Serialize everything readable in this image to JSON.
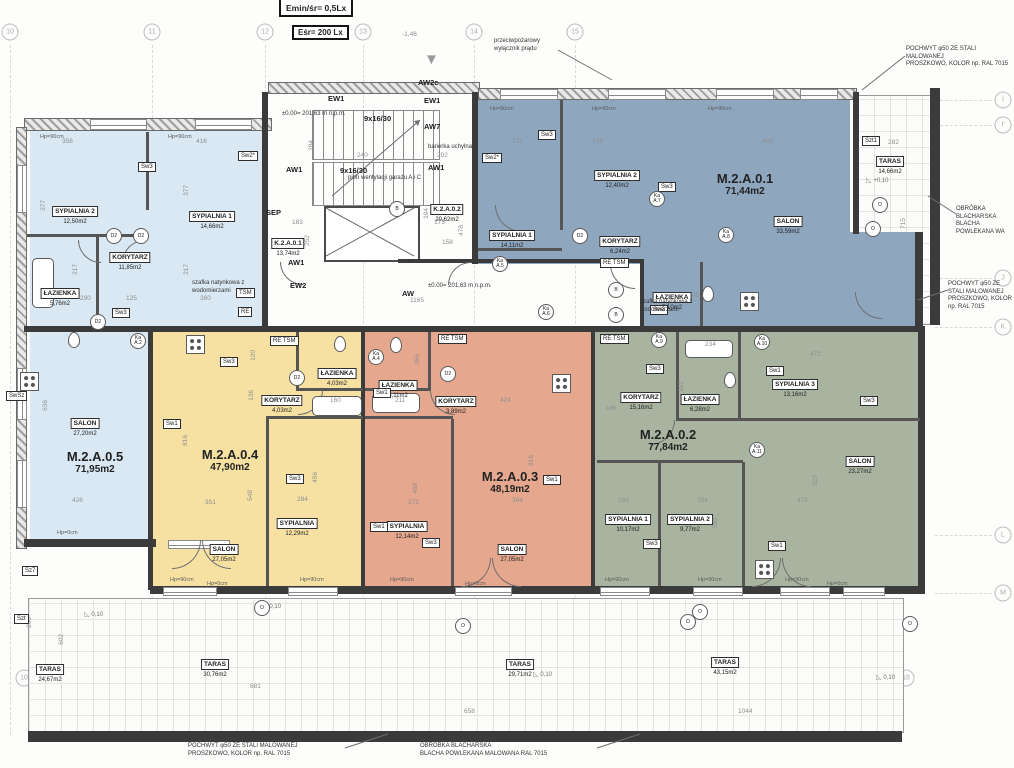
{
  "legend": {
    "l1": "Emin/śr= 0,5Lx",
    "l2": "Eśr=  200 Lx"
  },
  "icons": {
    "fire_triangle": "▼"
  },
  "grid": {
    "top": [
      {
        "l": "10",
        "x": 10
      },
      {
        "l": "11",
        "x": 152
      },
      {
        "l": "12",
        "x": 265
      },
      {
        "l": "13",
        "x": 363
      },
      {
        "l": "14",
        "x": 474
      },
      {
        "l": "15",
        "x": 575
      }
    ],
    "bottom": [
      {
        "l": "10",
        "x": 24
      },
      {
        "l": "11",
        "x": 153
      },
      {
        "l": "12",
        "x": 266
      },
      {
        "l": "14",
        "x": 474
      },
      {
        "l": "15",
        "x": 573
      },
      {
        "l": "16",
        "x": 748
      },
      {
        "l": "17",
        "x": 843
      },
      {
        "l": "18",
        "x": 906
      }
    ],
    "right": [
      {
        "l": "I",
        "y": 100
      },
      {
        "l": "I'",
        "y": 125
      },
      {
        "l": "J",
        "y": 278
      },
      {
        "l": "K",
        "y": 327
      },
      {
        "l": "L",
        "y": 535
      },
      {
        "l": "M",
        "y": 593
      }
    ]
  },
  "apartments": [
    {
      "id": "M.2.A.0.5",
      "area": "71,95m2",
      "color": "#d9e8f3",
      "lx": 95,
      "ly": 450,
      "rooms": [
        {
          "name": "SYPIALNIA 2",
          "area": "12,50m2",
          "x": 75,
          "y": 200
        },
        {
          "name": "SYPIALNIA 1",
          "area": "14,66m2",
          "x": 212,
          "y": 205
        },
        {
          "name": "KORYTARZ",
          "area": "11,85m2",
          "x": 130,
          "y": 246
        },
        {
          "name": "ŁAZIENKA",
          "area": "5,76m2",
          "x": 60,
          "y": 282
        },
        {
          "name": "SALON",
          "area": "27,20m2",
          "x": 85,
          "y": 412
        }
      ]
    },
    {
      "id": "M.2.A.0.1",
      "area": "71,44m2",
      "color": "#8ea7bf",
      "lx": 745,
      "ly": 172,
      "rooms": [
        {
          "name": "SYPIALNIA 2",
          "area": "12,40m2",
          "x": 617,
          "y": 164
        },
        {
          "name": "SYPIALNIA 1",
          "area": "14,11m2",
          "x": 512,
          "y": 224
        },
        {
          "name": "KORYTARZ",
          "area": "6,24m2",
          "x": 620,
          "y": 230
        },
        {
          "name": "SALON",
          "area": "33,59m2",
          "x": 788,
          "y": 210
        },
        {
          "name": "ŁAZIENKA",
          "area": "5,10m2",
          "x": 672,
          "y": 286
        }
      ]
    },
    {
      "id": "M.2.A.0.4",
      "area": "47,90m2",
      "color": "#f6e1a3",
      "lx": 230,
      "ly": 448,
      "rooms": [
        {
          "name": "ŁAZIENKA",
          "area": "4,03m2",
          "x": 337,
          "y": 362
        },
        {
          "name": "KORYTARZ",
          "area": "4,03m2",
          "x": 282,
          "y": 389
        },
        {
          "name": "SYPIALNIA",
          "area": "12,29m2",
          "x": 297,
          "y": 512
        },
        {
          "name": "SALON",
          "area": "27,05m2",
          "x": 224,
          "y": 538
        }
      ]
    },
    {
      "id": "M.2.A.0.3",
      "area": "48,19m2",
      "color": "#e5a78e",
      "lx": 510,
      "ly": 470,
      "rooms": [
        {
          "name": "ŁAZIENKA",
          "area": "5,11m2",
          "x": 398,
          "y": 374
        },
        {
          "name": "KORYTARZ",
          "area": "3,89m2",
          "x": 456,
          "y": 390
        },
        {
          "name": "SYPIALNIA",
          "area": "12,14m2",
          "x": 407,
          "y": 515
        },
        {
          "name": "SALON",
          "area": "27,05m2",
          "x": 512,
          "y": 538
        }
      ]
    },
    {
      "id": "M.2.A.0.2",
      "area": "77,84m2",
      "color": "#a8b4a0",
      "lx": 668,
      "ly": 428,
      "rooms": [
        {
          "name": "KORYTARZ",
          "area": "15,16m2",
          "x": 641,
          "y": 386
        },
        {
          "name": "ŁAZIENKA",
          "area": "6,28m2",
          "x": 700,
          "y": 388
        },
        {
          "name": "SYPIALNIA 3",
          "area": "13,16m2",
          "x": 795,
          "y": 373
        },
        {
          "name": "SALON",
          "area": "23,27m2",
          "x": 860,
          "y": 450
        },
        {
          "name": "SYPIALNIA 1",
          "area": "10,17m2",
          "x": 628,
          "y": 508
        },
        {
          "name": "SYPIALNIA 2",
          "area": "9,77m2",
          "x": 690,
          "y": 508
        }
      ]
    }
  ],
  "core_rooms": [
    {
      "name": "K.2.A.0.1",
      "area": "13,74m2",
      "x": 288,
      "y": 232
    },
    {
      "name": "K.2.A.0.2",
      "area": "20,62m2",
      "x": 447,
      "y": 198
    }
  ],
  "terraces": [
    {
      "name": "TARAS",
      "area": "24,67m2",
      "x": 50,
      "y": 658
    },
    {
      "name": "TARAS",
      "area": "30,76m2",
      "x": 215,
      "y": 653
    },
    {
      "name": "TARAS",
      "area": "29,71m2",
      "x": 520,
      "y": 653
    },
    {
      "name": "TARAS",
      "area": "43,15m2",
      "x": 725,
      "y": 651
    },
    {
      "name": "TARAS",
      "area": "14,66m2",
      "x": 890,
      "y": 150
    }
  ],
  "labels": [
    {
      "t": "EW1",
      "x": 328,
      "y": 94
    },
    {
      "t": "EW1",
      "x": 424,
      "y": 96
    },
    {
      "t": "AW7",
      "x": 424,
      "y": 122
    },
    {
      "t": "AW2c",
      "x": 418,
      "y": 78
    },
    {
      "t": "AW1",
      "x": 286,
      "y": 165
    },
    {
      "t": "AW1",
      "x": 428,
      "y": 163
    },
    {
      "t": "AW1",
      "x": 288,
      "y": 258
    },
    {
      "t": "EW2",
      "x": 290,
      "y": 281
    },
    {
      "t": "SEP",
      "x": 266,
      "y": 208
    },
    {
      "t": "AW",
      "x": 402,
      "y": 289
    },
    {
      "t": "9x16/30",
      "x": 364,
      "y": 114
    },
    {
      "t": "9x16/30",
      "x": 340,
      "y": 166
    }
  ],
  "tags": [
    {
      "t": "Sw3",
      "x": 138,
      "y": 162
    },
    {
      "t": "Sw2*",
      "x": 238,
      "y": 151
    },
    {
      "t": "Sw3",
      "x": 112,
      "y": 308
    },
    {
      "t": "SwSz",
      "x": 6,
      "y": 391
    },
    {
      "t": "Sz7",
      "x": 22,
      "y": 566
    },
    {
      "t": "Szt",
      "x": 14,
      "y": 614
    },
    {
      "t": "Szt1",
      "x": 862,
      "y": 136
    },
    {
      "t": "Sw1",
      "x": 163,
      "y": 419
    },
    {
      "t": "Sw3",
      "x": 220,
      "y": 357
    },
    {
      "t": "Sw3",
      "x": 286,
      "y": 474
    },
    {
      "t": "Sw1",
      "x": 373,
      "y": 388
    },
    {
      "t": "Sw1",
      "x": 370,
      "y": 522
    },
    {
      "t": "Sw3",
      "x": 422,
      "y": 538
    },
    {
      "t": "Sw1",
      "x": 543,
      "y": 475
    },
    {
      "t": "Sw3",
      "x": 646,
      "y": 364
    },
    {
      "t": "Sw1",
      "x": 766,
      "y": 366
    },
    {
      "t": "Sw3",
      "x": 860,
      "y": 396
    },
    {
      "t": "Sw3",
      "x": 643,
      "y": 539
    },
    {
      "t": "Sw1",
      "x": 768,
      "y": 541
    },
    {
      "t": "Sw3",
      "x": 538,
      "y": 130
    },
    {
      "t": "Sw2*",
      "x": 482,
      "y": 153
    },
    {
      "t": "Sw3",
      "x": 658,
      "y": 182
    },
    {
      "t": "Sw2",
      "x": 650,
      "y": 305
    },
    {
      "t": "TSM",
      "x": 236,
      "y": 288
    },
    {
      "t": "RE",
      "x": 238,
      "y": 307
    },
    {
      "t": "RE TSM",
      "x": 270,
      "y": 336
    },
    {
      "t": "RE TSM",
      "x": 438,
      "y": 334
    },
    {
      "t": "RE TSM",
      "x": 600,
      "y": 334
    },
    {
      "t": "RE TSM",
      "x": 600,
      "y": 258
    }
  ],
  "circles": [
    {
      "t": "D2",
      "x": 114,
      "y": 236
    },
    {
      "t": "D2",
      "x": 141,
      "y": 236
    },
    {
      "t": "D2",
      "x": 98,
      "y": 322
    },
    {
      "t": "D2",
      "x": 580,
      "y": 236
    },
    {
      "t": "D2",
      "x": 448,
      "y": 374
    },
    {
      "t": "D2",
      "x": 297,
      "y": 378
    },
    {
      "t": "B",
      "x": 397,
      "y": 209
    },
    {
      "t": "B",
      "x": 616,
      "y": 290
    },
    {
      "t": "B",
      "x": 616,
      "y": 315
    },
    {
      "t": "Ka\nA.2",
      "x": 138,
      "y": 341
    },
    {
      "t": "Ka\nA.4",
      "x": 376,
      "y": 357
    },
    {
      "t": "Ka\nA.9",
      "x": 659,
      "y": 340
    },
    {
      "t": "Ka\nA.10",
      "x": 762,
      "y": 342
    },
    {
      "t": "Ka\nA.11",
      "x": 757,
      "y": 450
    },
    {
      "t": "Ka\nA.7",
      "x": 657,
      "y": 199
    },
    {
      "t": "Ka\nA.8",
      "x": 726,
      "y": 235
    },
    {
      "t": "Ka\nA.5",
      "x": 500,
      "y": 264
    },
    {
      "t": "Ka\nA.6",
      "x": 546,
      "y": 312
    },
    {
      "t": "O",
      "x": 262,
      "y": 608
    },
    {
      "t": "O",
      "x": 463,
      "y": 626
    },
    {
      "t": "O",
      "x": 688,
      "y": 622
    },
    {
      "t": "O",
      "x": 910,
      "y": 624
    },
    {
      "t": "O",
      "x": 880,
      "y": 205
    },
    {
      "t": "O",
      "x": 873,
      "y": 229
    },
    {
      "t": "O",
      "x": 700,
      "y": 612
    }
  ],
  "dims": [
    {
      "t": "358",
      "x": 62,
      "y": 138
    },
    {
      "t": "416",
      "x": 196,
      "y": 138
    },
    {
      "t": "377",
      "x": 40,
      "y": 200,
      "v": 1
    },
    {
      "t": "377",
      "x": 183,
      "y": 185,
      "v": 1
    },
    {
      "t": "290",
      "x": 80,
      "y": 295
    },
    {
      "t": "125",
      "x": 126,
      "y": 295
    },
    {
      "t": "360",
      "x": 200,
      "y": 295
    },
    {
      "t": "217",
      "x": 72,
      "y": 264,
      "v": 1
    },
    {
      "t": "217",
      "x": 183,
      "y": 264,
      "v": 1
    },
    {
      "t": "636",
      "x": 42,
      "y": 400,
      "v": 1
    },
    {
      "t": "426",
      "x": 72,
      "y": 497
    },
    {
      "t": "816",
      "x": 182,
      "y": 435,
      "v": 1
    },
    {
      "t": "351",
      "x": 205,
      "y": 499
    },
    {
      "t": "548",
      "x": 247,
      "y": 490,
      "v": 1
    },
    {
      "t": "456",
      "x": 312,
      "y": 472,
      "v": 1
    },
    {
      "t": "284",
      "x": 297,
      "y": 496
    },
    {
      "t": "120",
      "x": 250,
      "y": 350,
      "v": 1
    },
    {
      "t": "136",
      "x": 248,
      "y": 390,
      "v": 1
    },
    {
      "t": "160",
      "x": 330,
      "y": 397
    },
    {
      "t": "424",
      "x": 500,
      "y": 397
    },
    {
      "t": "364",
      "x": 512,
      "y": 497
    },
    {
      "t": "468",
      "x": 412,
      "y": 483,
      "v": 1
    },
    {
      "t": "271",
      "x": 408,
      "y": 499
    },
    {
      "t": "211",
      "x": 395,
      "y": 397
    },
    {
      "t": "256",
      "x": 414,
      "y": 354,
      "v": 1
    },
    {
      "t": "816",
      "x": 528,
      "y": 455,
      "v": 1
    },
    {
      "t": "234",
      "x": 705,
      "y": 341
    },
    {
      "t": "472",
      "x": 810,
      "y": 351
    },
    {
      "t": "282",
      "x": 678,
      "y": 381,
      "v": 1
    },
    {
      "t": "146",
      "x": 605,
      "y": 405
    },
    {
      "t": "264",
      "x": 618,
      "y": 497
    },
    {
      "t": "254",
      "x": 697,
      "y": 497
    },
    {
      "t": "472",
      "x": 797,
      "y": 497
    },
    {
      "t": "522",
      "x": 812,
      "y": 475,
      "v": 1
    },
    {
      "t": "390",
      "x": 712,
      "y": 518,
      "v": 1
    },
    {
      "t": "271",
      "x": 512,
      "y": 138
    },
    {
      "t": "379",
      "x": 592,
      "y": 138
    },
    {
      "t": "483",
      "x": 762,
      "y": 138
    },
    {
      "t": "275",
      "x": 688,
      "y": 292
    },
    {
      "t": "284",
      "x": 308,
      "y": 140,
      "v": 1
    },
    {
      "t": "240",
      "x": 357,
      "y": 152
    },
    {
      "t": "202",
      "x": 437,
      "y": 152
    },
    {
      "t": "478",
      "x": 458,
      "y": 225,
      "v": 1
    },
    {
      "t": "194",
      "x": 423,
      "y": 208,
      "v": 1
    },
    {
      "t": "173",
      "x": 434,
      "y": 219
    },
    {
      "t": "183",
      "x": 292,
      "y": 219
    },
    {
      "t": "168",
      "x": 294,
      "y": 242
    },
    {
      "t": "252",
      "x": 304,
      "y": 235,
      "v": 1
    },
    {
      "t": "158",
      "x": 442,
      "y": 239
    },
    {
      "t": "1165",
      "x": 410,
      "y": 297
    },
    {
      "t": "-1,46",
      "x": 402,
      "y": 31
    },
    {
      "t": "282",
      "x": 888,
      "y": 139
    },
    {
      "t": "715",
      "x": 900,
      "y": 218,
      "v": 1
    },
    {
      "t": "200",
      "x": 26,
      "y": 617,
      "v": 1
    },
    {
      "t": "602",
      "x": 58,
      "y": 634,
      "v": 1
    },
    {
      "t": "681",
      "x": 250,
      "y": 683
    },
    {
      "t": "658",
      "x": 464,
      "y": 708
    },
    {
      "t": "1044",
      "x": 738,
      "y": 708
    }
  ],
  "sills": [
    {
      "t": "Hp=90cm",
      "x": 40,
      "y": 134
    },
    {
      "t": "Hp=90cm",
      "x": 168,
      "y": 134
    },
    {
      "t": "Hp=90cm",
      "x": 490,
      "y": 106
    },
    {
      "t": "Hp=90cm",
      "x": 592,
      "y": 106
    },
    {
      "t": "Hp=90cm",
      "x": 708,
      "y": 106
    },
    {
      "t": "Hp=90cm",
      "x": 170,
      "y": 577
    },
    {
      "t": "Hp=90cm",
      "x": 300,
      "y": 577
    },
    {
      "t": "Hp=90cm",
      "x": 390,
      "y": 577
    },
    {
      "t": "Hp=90cm",
      "x": 605,
      "y": 577
    },
    {
      "t": "Hp=90cm",
      "x": 698,
      "y": 577
    },
    {
      "t": "Hp=90cm",
      "x": 785,
      "y": 577
    },
    {
      "t": "Hp=0cm",
      "x": 57,
      "y": 530
    },
    {
      "t": "Hp=0cm",
      "x": 207,
      "y": 581
    },
    {
      "t": "Hp=0cm",
      "x": 465,
      "y": 581
    },
    {
      "t": "Hp=0cm",
      "x": 827,
      "y": 581
    }
  ],
  "slopes": [
    {
      "t": "0,10",
      "x": 84,
      "y": 610
    },
    {
      "t": "0,10",
      "x": 533,
      "y": 670
    },
    {
      "t": "0,10",
      "x": 876,
      "y": 673
    },
    {
      "t": "+0,10",
      "x": 866,
      "y": 176
    },
    {
      "t": "0,10",
      "x": 262,
      "y": 602
    }
  ],
  "annotations": [
    {
      "t": "przeciwpożarowy\nwyłącznik prądu",
      "x": 494,
      "y": 38,
      "w": 90
    },
    {
      "t": "szafka natynkowa z\nwodomierzami",
      "x": 192,
      "y": 280,
      "w": 82
    },
    {
      "t": "szafka natynkowa z\nwodomierzami",
      "x": 640,
      "y": 299,
      "w": 82
    },
    {
      "t": "barierka uchylna",
      "x": 428,
      "y": 144,
      "w": 70
    },
    {
      "t": "±0.00= 201,63 m n.p.m.",
      "x": 282,
      "y": 111,
      "w": 100
    },
    {
      "t": "±0.00= 201,63 m n.p.m.",
      "x": 428,
      "y": 283,
      "w": 100
    },
    {
      "t": "pion wentylacji garażu A i C",
      "x": 348,
      "y": 175,
      "w": 110
    },
    {
      "t": "POCHWYT φ50 ZE STALI MALOWANEJ\nPROSZKOWO, KOLOR np. RAL 7015",
      "x": 906,
      "y": 46,
      "w": 108
    },
    {
      "t": "OBRÓBKA BLACHARSKA\nBLACHA POWLEKANA WA",
      "x": 956,
      "y": 206,
      "w": 58
    },
    {
      "t": "POCHWYT φ50 ZE STALI MALOWANEJ\nPROSZKOWO, KOLOR np. RAL 7015",
      "x": 948,
      "y": 281,
      "w": 64
    },
    {
      "t": "POCHWYT φ50 ZE STALI MALOWANEJ\nPROSZKOWO, KOLOR np. RAL 7015",
      "x": 188,
      "y": 743,
      "w": 155
    },
    {
      "t": "OBRÓBKA BLACHARSKA\nBLACHA POWLEKANA MALOWANA RAL 7015",
      "x": 420,
      "y": 743,
      "w": 175
    }
  ]
}
